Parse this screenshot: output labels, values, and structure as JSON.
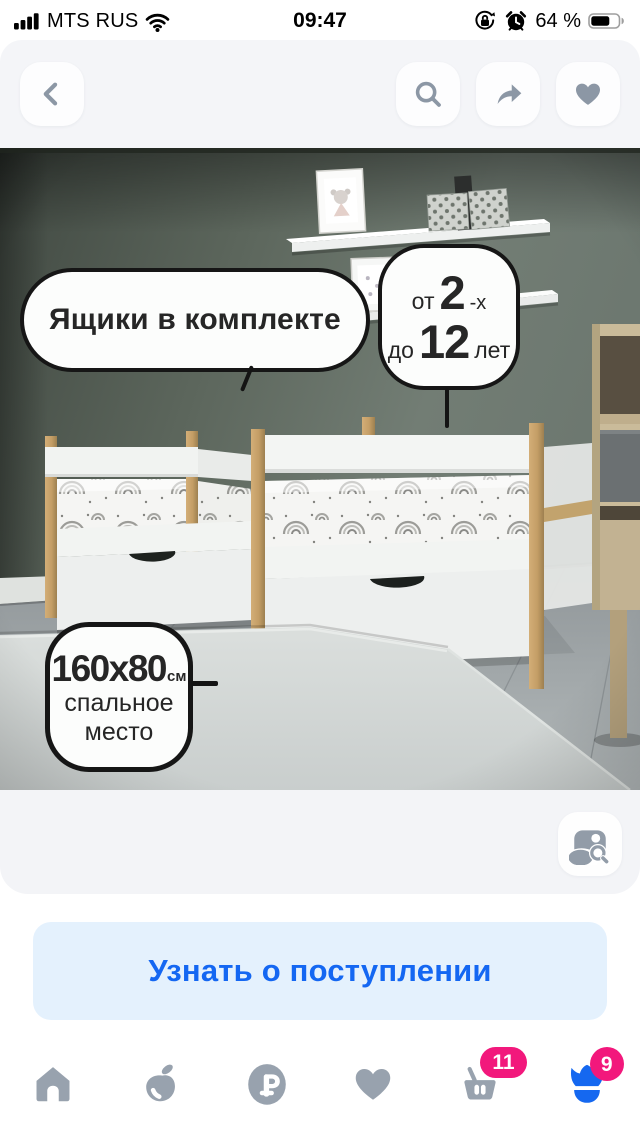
{
  "status_bar": {
    "carrier": "MTS RUS",
    "time": "09:47",
    "battery": "64 %",
    "icons": {
      "left": [
        "signal-bars",
        "wifi"
      ],
      "right": [
        "orientation-lock",
        "alarm-clock",
        "battery"
      ]
    }
  },
  "nav_bar": {
    "icons": {
      "back": "chevron-left",
      "search": "magnifier",
      "share": "forward-arrow",
      "favorite": "heart"
    }
  },
  "photo": {
    "callouts": {
      "drawers": {
        "text": "Ящики в комплекте"
      },
      "age": {
        "word_from": "от",
        "age_from": "2",
        "age_from_suffix": "-х",
        "word_to": "до",
        "age_to": "12",
        "age_to_suffix": "лет"
      },
      "size": {
        "dimensions": "160x80",
        "unit": "см",
        "caption_line1": "спальное",
        "caption_line2": "место"
      }
    },
    "photo_search_icon": "image-search"
  },
  "cta": {
    "label": "Узнать о поступлении"
  },
  "tab_bar": {
    "items": [
      {
        "id": "home",
        "icon": "house-icon"
      },
      {
        "id": "products",
        "icon": "apple-icon"
      },
      {
        "id": "prices",
        "icon": "ruble-icon",
        "symbol": "₽"
      },
      {
        "id": "favorites",
        "icon": "heart-icon"
      },
      {
        "id": "cart",
        "icon": "basket-icon",
        "badge": "11"
      },
      {
        "id": "profile",
        "icon": "tulip-icon",
        "badge": "9",
        "active": true
      }
    ]
  },
  "colors": {
    "accent_blue": "#1467f2",
    "badge_pink": "#f2187c",
    "cta_bg": "#e4f1fd",
    "panel_gray": "#f3f4f7",
    "icon_gray": "#98a2ae"
  }
}
